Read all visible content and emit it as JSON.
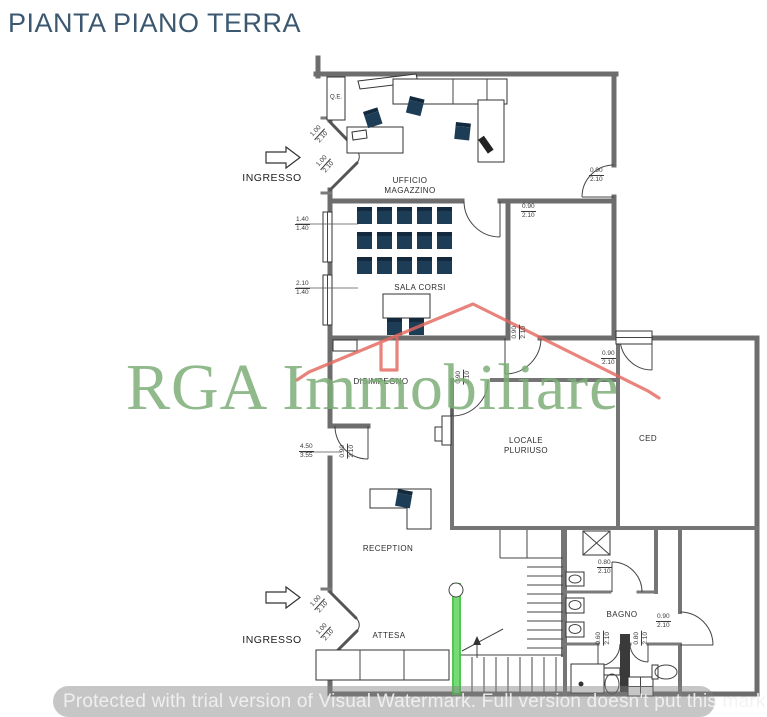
{
  "title": "PIANTA PIANO TERRA",
  "watermark": {
    "brand": "RGA Immobiliare",
    "notice": "Protected with trial version of Visual Watermark. Full version doesn't put this mark."
  },
  "labels": {
    "ingresso_top": "INGRESSO",
    "ingresso_bottom": "INGRESSO"
  },
  "rooms": [
    {
      "id": "ufficio-magazzino",
      "label": "UFFICIO MAGAZZINO"
    },
    {
      "id": "sala-corsi",
      "label": "SALA CORSI"
    },
    {
      "id": "disimpegno",
      "label": "DISIMPEGNO"
    },
    {
      "id": "locale-pluriuso",
      "label": "LOCALE PLURIUSO"
    },
    {
      "id": "ced",
      "label": "CED"
    },
    {
      "id": "reception",
      "label": "RECEPTION"
    },
    {
      "id": "attesa",
      "label": "ATTESA"
    },
    {
      "id": "bagno",
      "label": "BAGNO"
    },
    {
      "id": "quadro-elettrico",
      "label": "Q.E."
    }
  ],
  "dimensions": [
    {
      "w": "0.90",
      "h": "2.10"
    },
    {
      "w": "0.90",
      "h": "2.10"
    },
    {
      "w": "1.40",
      "h": "1.40"
    },
    {
      "w": "2.10",
      "h": "1.40"
    },
    {
      "w": "0.90",
      "h": "2.10"
    },
    {
      "w": "0.90",
      "h": "2.10"
    },
    {
      "w": "0.90",
      "h": "2.10"
    },
    {
      "w": "4.50",
      "h": "3.55"
    },
    {
      "w": "0.90",
      "h": "2.10"
    },
    {
      "w": "0.80",
      "h": "2.10"
    },
    {
      "w": "0.90",
      "h": "2.10"
    },
    {
      "w": "0.60",
      "h": "2.10"
    },
    {
      "w": "0.80",
      "h": "2.10"
    },
    {
      "w": "1.00",
      "h": "2.10"
    },
    {
      "w": "1.00",
      "h": "2.10"
    },
    {
      "w": "1.00",
      "h": "2.10"
    },
    {
      "w": "1.00",
      "h": "2.10"
    }
  ],
  "colors": {
    "title": "#3C5870",
    "walls": "#6D6D6D",
    "furniture_navy": "#1D3C55",
    "watermark_green": "#7CAE78",
    "watermark_red": "#E4685F",
    "highlight_green": "#3EC33E",
    "notice_gray": "#808080"
  }
}
